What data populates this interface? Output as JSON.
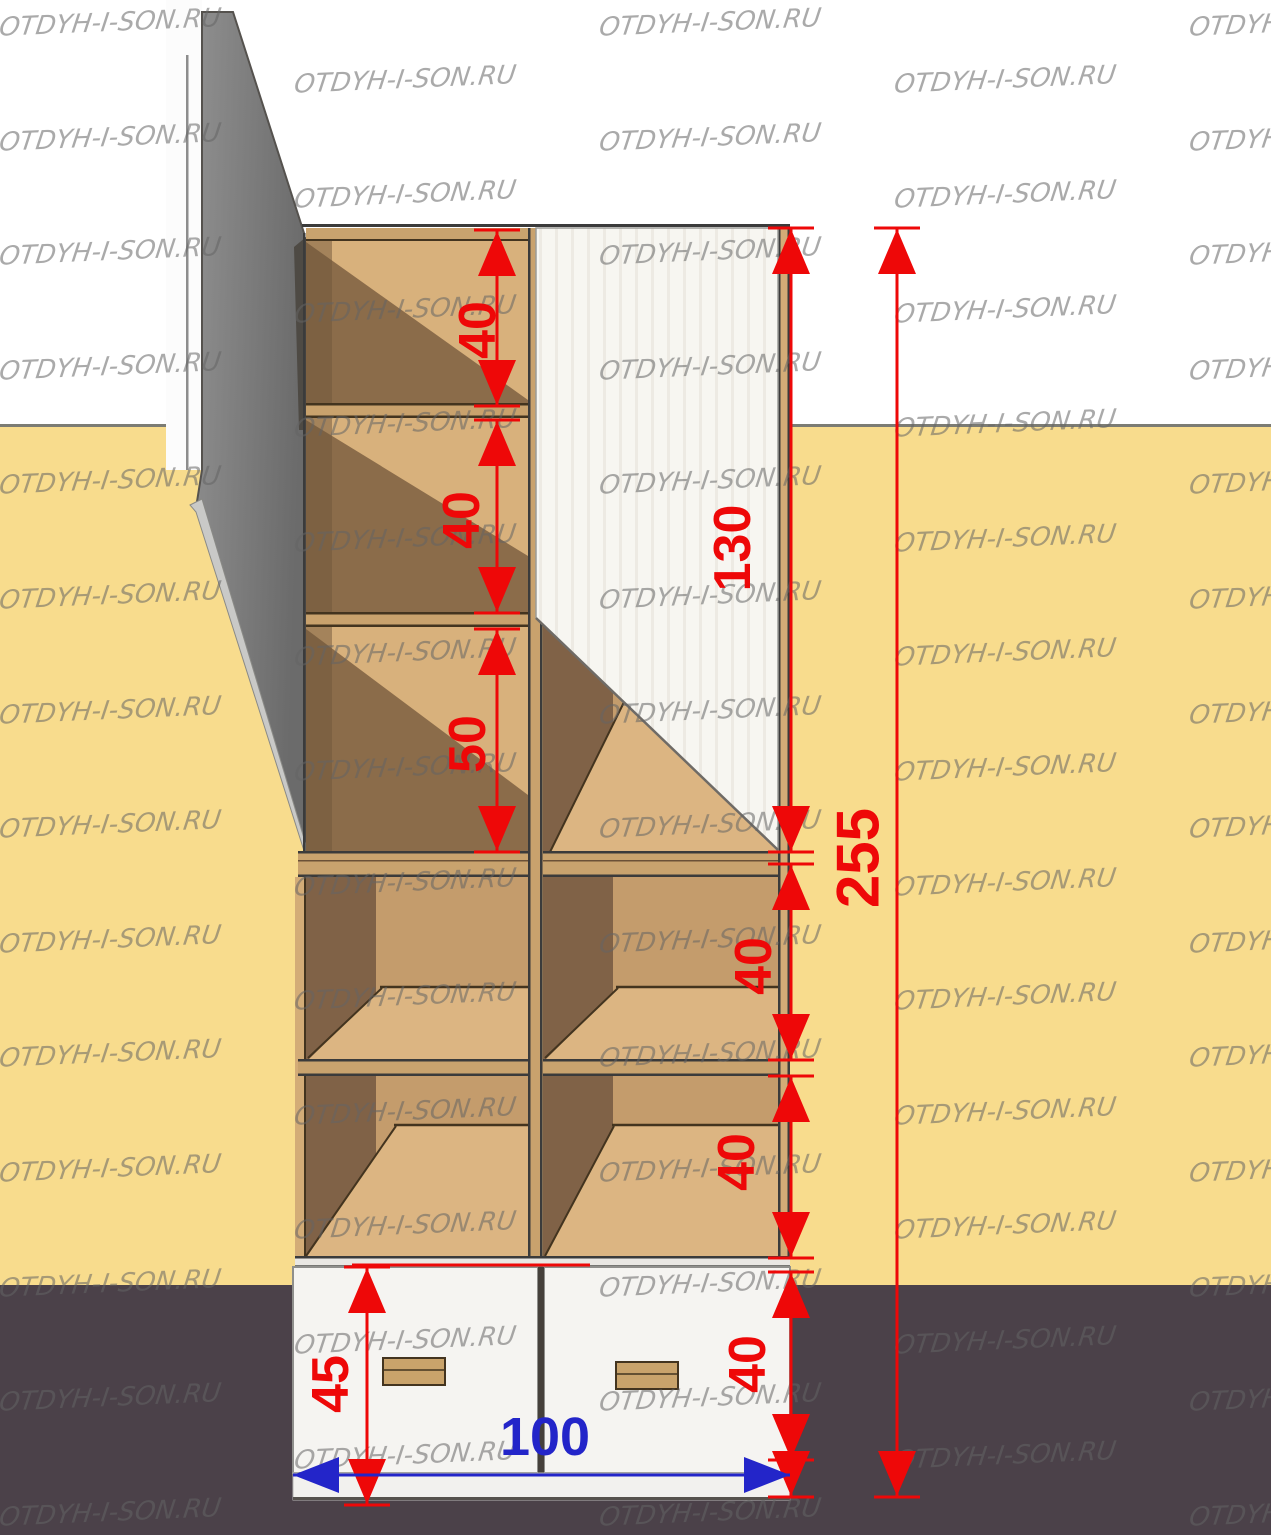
{
  "watermark": {
    "text": "OTDYH-I-SON.RU"
  },
  "dimensions": {
    "shelf1_height": "40",
    "shelf2_height": "40",
    "shelf3_height": "50",
    "door_height": "130",
    "shelf4_height": "40",
    "shelf5_height": "40",
    "drawer_front_height": "40",
    "drawer_total_height": "45",
    "total_width": "100",
    "total_height": "255"
  },
  "colors": {
    "dimension_red": "#ee0808",
    "dimension_blue": "#2325c9",
    "wall_yellow": "#f8dc8d",
    "floor_dark": "#4b4149",
    "side_panel_gray": "#7f7f7f",
    "wood_light": "#d8b17c",
    "wood_shadow": "#8b6c4a",
    "watermark_gray": "#6c6c6c"
  }
}
